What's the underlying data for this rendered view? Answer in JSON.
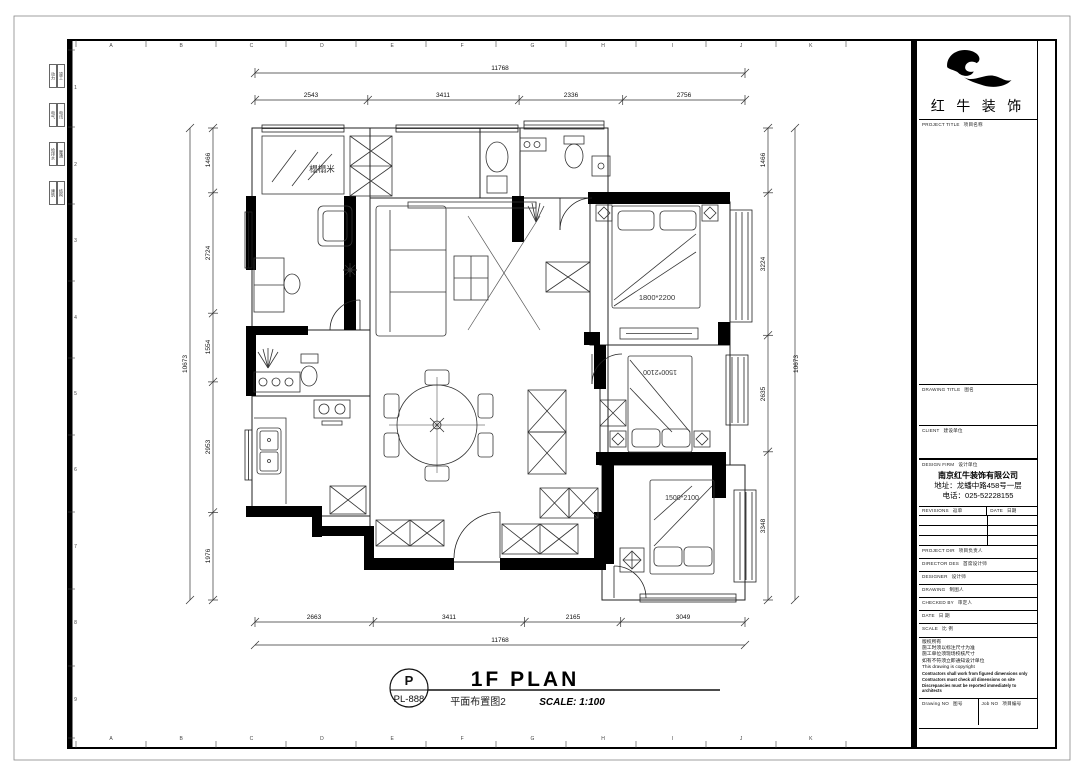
{
  "sheet": {
    "grid_letters": [
      "A",
      "B",
      "C",
      "D",
      "E",
      "F",
      "G",
      "H",
      "I",
      "J",
      "K"
    ],
    "grid_numbers": [
      "1",
      "2",
      "3",
      "4",
      "5",
      "6",
      "7",
      "8",
      "9"
    ],
    "disciplines": [
      "动力",
      "竣工",
      "电气",
      "电讯",
      "给排水",
      "暖通",
      "建筑",
      "结构"
    ]
  },
  "plan": {
    "room_tatami": "榻榻米",
    "bed_master": "1800*2200",
    "bed_2": "1500*2100",
    "bed_3": "1500*2100"
  },
  "dims": {
    "top": {
      "total": "11768",
      "segments": [
        "2543",
        "3411",
        "2336",
        "2756"
      ]
    },
    "bottom": {
      "total": "11768",
      "segments": [
        "2663",
        "3411",
        "2165",
        "3049"
      ]
    },
    "left": {
      "total": "10673",
      "segments": [
        "1466",
        "2724",
        "1554",
        "2953",
        "1976"
      ]
    },
    "right": {
      "total": "10673",
      "segments": [
        "1466",
        "3224",
        "2635",
        "3348"
      ]
    }
  },
  "title_bar": {
    "tag_letter": "P",
    "tag_code": "PL-888",
    "title": "1F PLAN",
    "subtitle": "平面布置图2",
    "scale": "SCALE: 1:100"
  },
  "title_block": {
    "brand": "红 牛 装 饰",
    "sections": {
      "project": {
        "en": "PROJECT TITLE",
        "zh": "项目名称"
      },
      "drawing": {
        "en": "DRAWING TITLE",
        "zh": "图名"
      },
      "client": {
        "en": "CLIENT",
        "zh": "建设单位"
      },
      "firm": {
        "en": "DESIGN FIRM",
        "zh": "设计单位"
      }
    },
    "firm_name": "南京红牛装饰有限公司",
    "firm_address": "地址：龙蟠中路458号一层",
    "firm_phone": "电话：025-52228155",
    "revisions": {
      "en": "REVISIONS",
      "zh": "返单"
    },
    "date_col": {
      "en": "DATE",
      "zh": "日期"
    },
    "rows": [
      {
        "en": "PROJECT DIR",
        "zh": "项目负责人"
      },
      {
        "en": "DIRECTOR DES",
        "zh": "首席设计师"
      },
      {
        "en": "DESIGNER",
        "zh": "设计师"
      },
      {
        "en": "DRAWING",
        "zh": "制图人"
      },
      {
        "en": "CHECKED BY",
        "zh": "审定人"
      },
      {
        "en": "DATE",
        "zh": "日  期"
      },
      {
        "en": "SCALE",
        "zh": "比  例"
      }
    ],
    "notes": [
      "版权所有",
      "施工时须以标注尺寸为准",
      "施工单位须现场校核尺寸",
      "如有不符须立即通知设计单位",
      "This drawing is copyright"
    ],
    "notes_bold": [
      "Contractors shall work from figured dimensions only",
      "Contractors must check all dimensions on site",
      "Discrepancies must be reported immediately to architects"
    ],
    "drawing_no": {
      "en": "Drawing NO",
      "zh": "图号"
    },
    "job_no": {
      "en": "Job NO",
      "zh": "项目编号"
    }
  }
}
